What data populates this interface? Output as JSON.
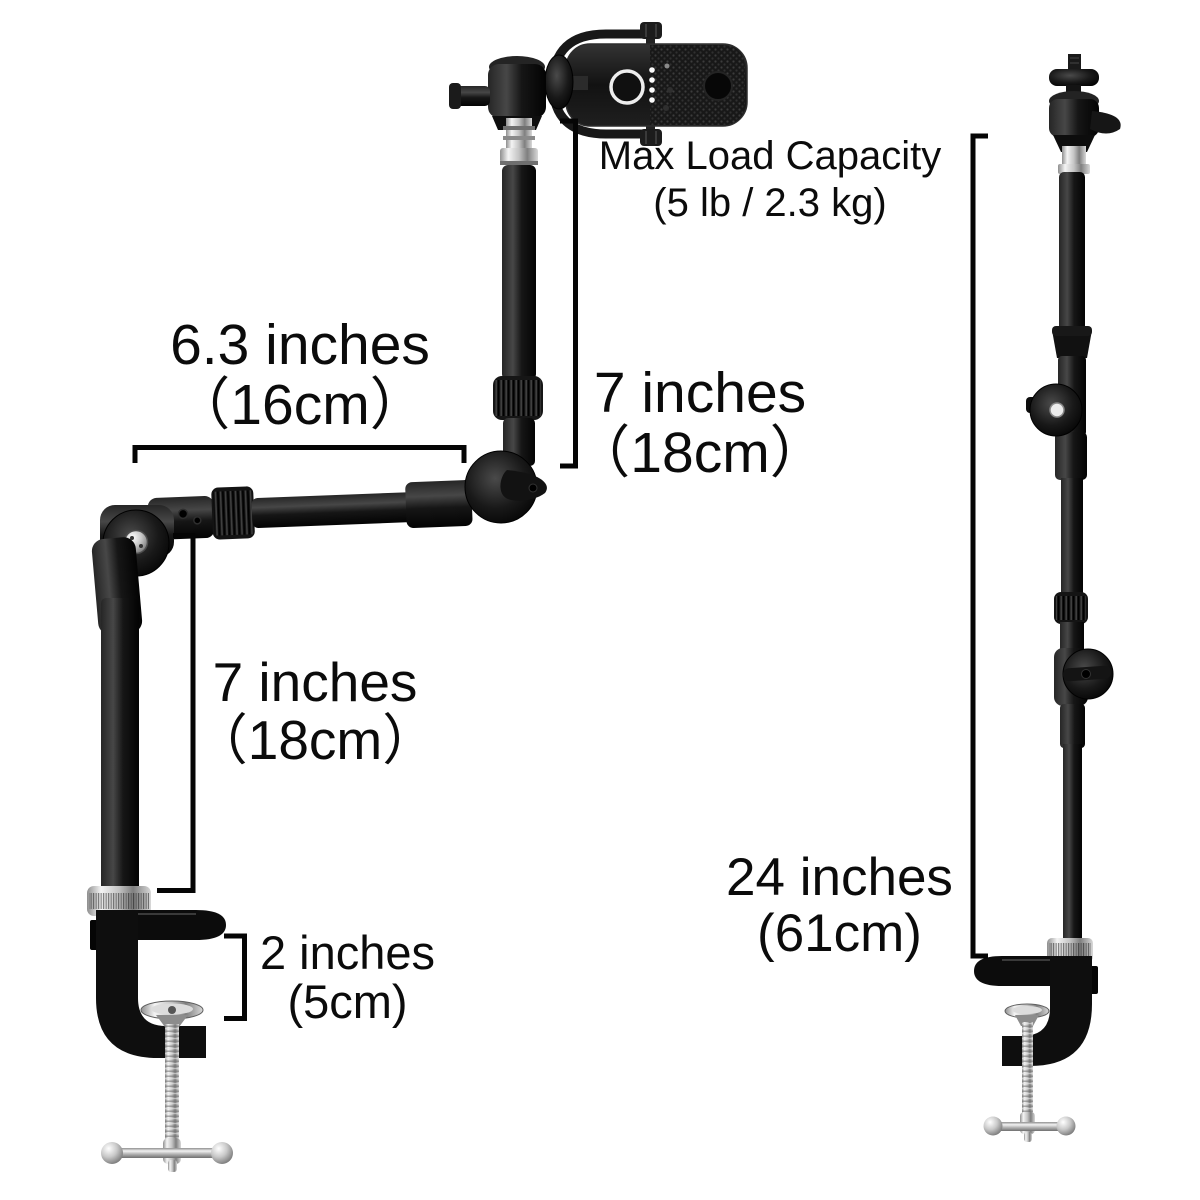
{
  "colors": {
    "background": "#ffffff",
    "ink": "#0b0b0b",
    "product_black": "#141414",
    "chrome": "#c9c9c9"
  },
  "annotations": {
    "max_load": {
      "line1": "Max Load Capacity",
      "line2": "(5 lb / 2.3 kg)"
    },
    "arm_length": {
      "line1": "6.3 inches",
      "line2": "（16cm）"
    },
    "upper_riser": {
      "line1": "7 inches",
      "line2": "（18cm）"
    },
    "lower_riser": {
      "line1": "7 inches",
      "line2": "（18cm）"
    },
    "clamp_opening": {
      "line1": "2 inches",
      "line2": "(5cm)"
    },
    "pole_height": {
      "line1": "24 inches",
      "line2": "(61cm)"
    }
  }
}
